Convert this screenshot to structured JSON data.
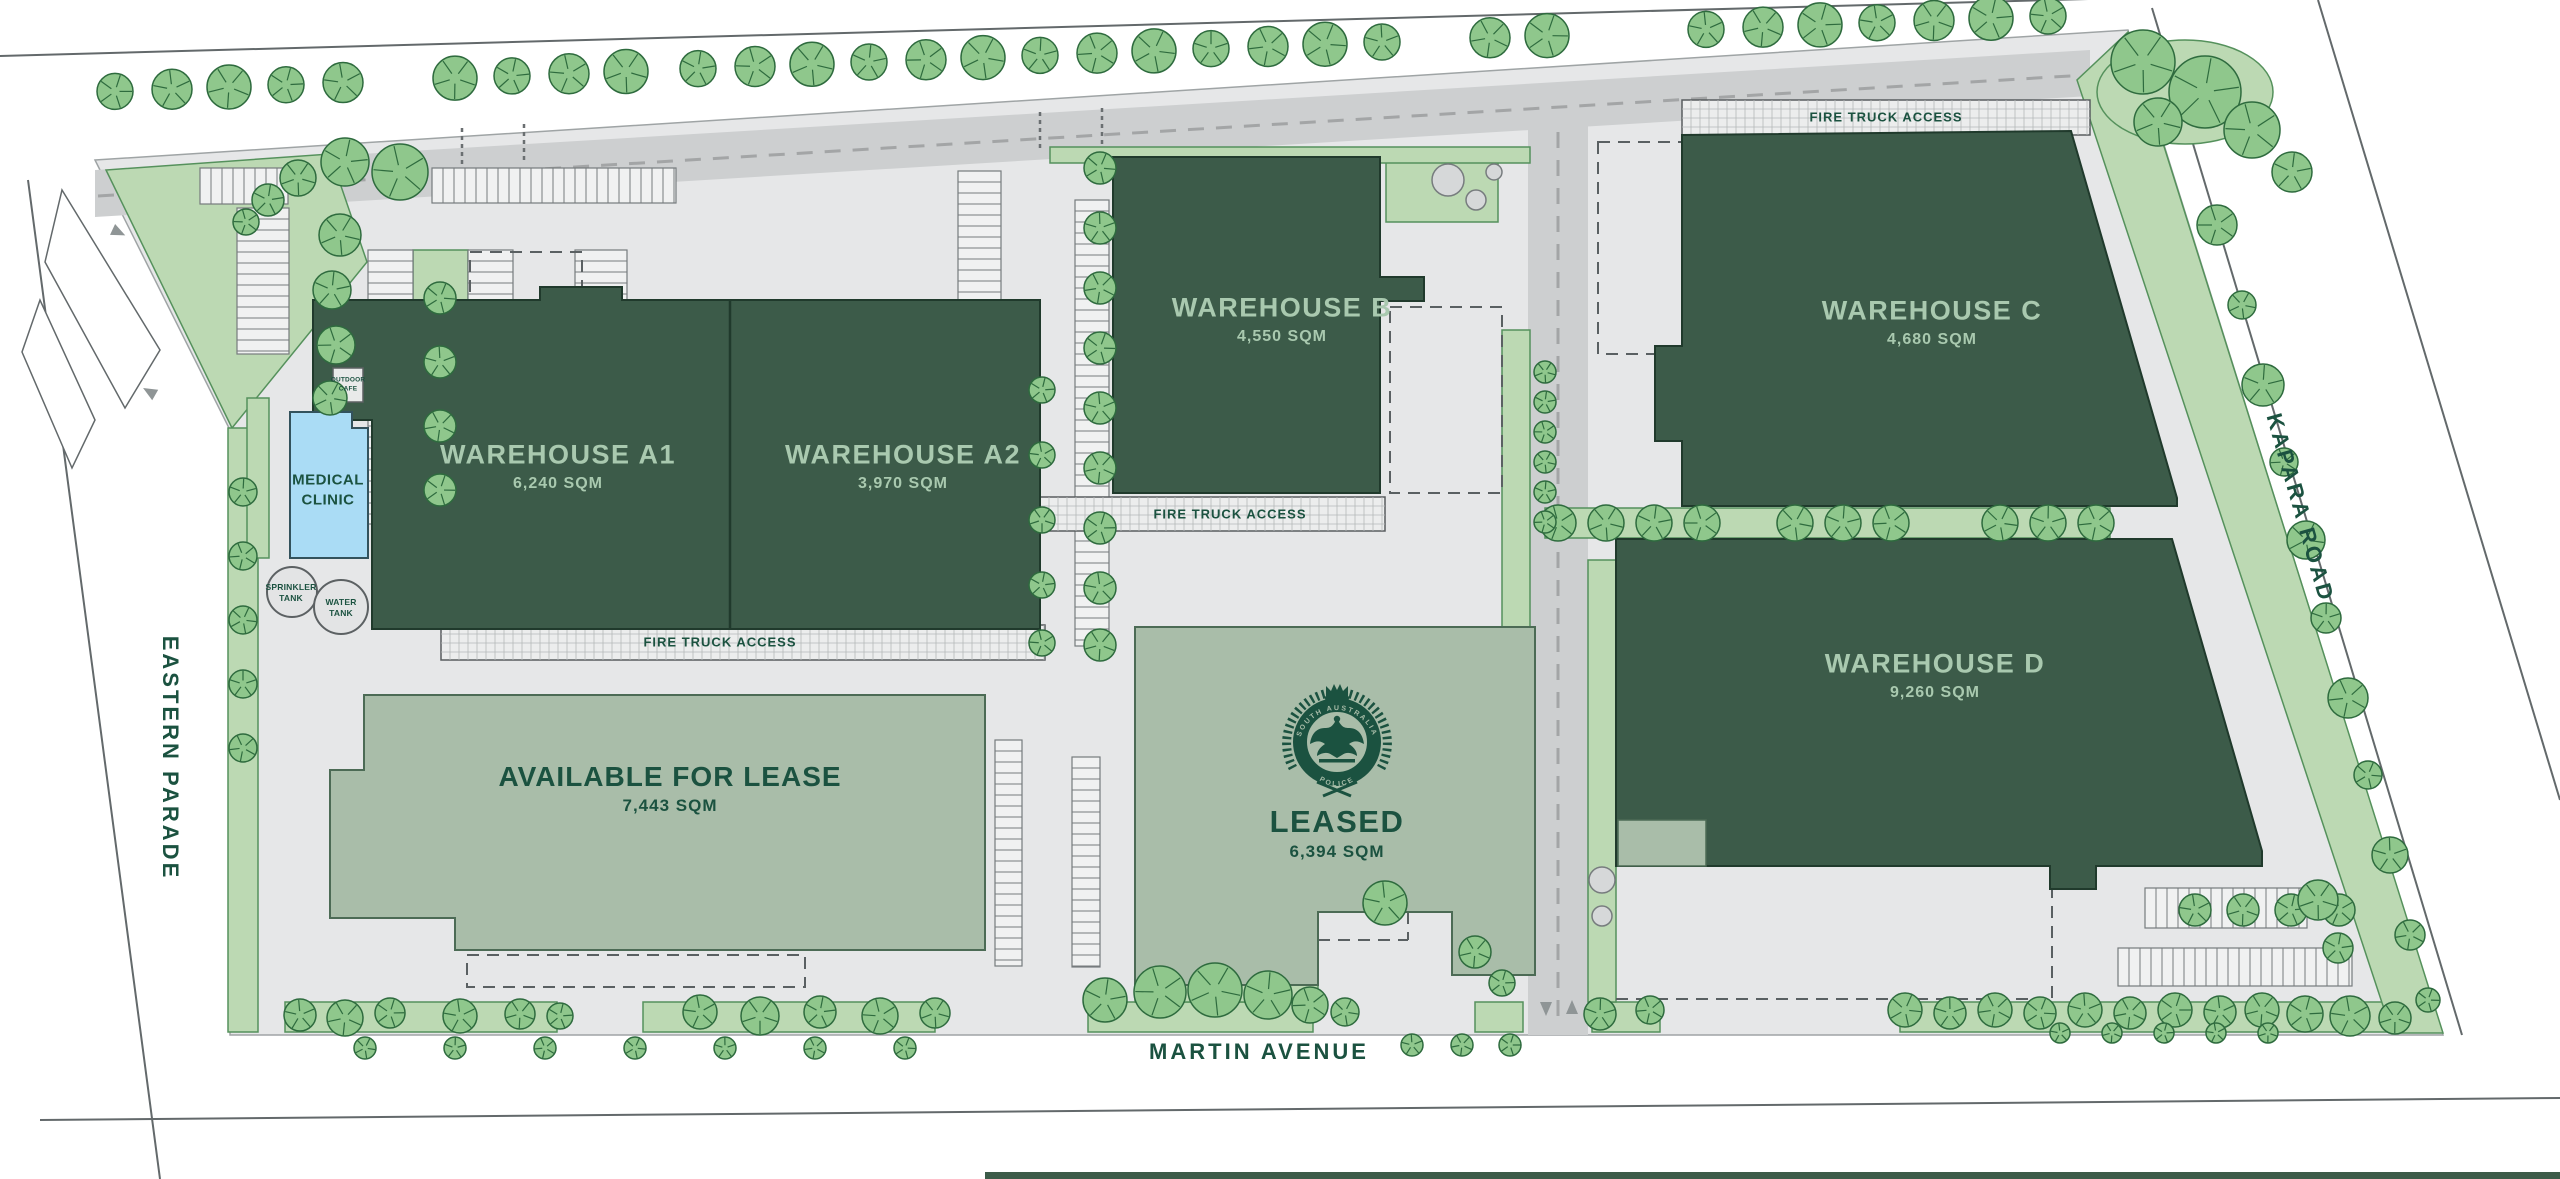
{
  "plan": {
    "buildings": {
      "a1": {
        "name": "WAREHOUSE A1",
        "area": "6,240 SQM"
      },
      "a2": {
        "name": "WAREHOUSE A2",
        "area": "3,970 SQM"
      },
      "b": {
        "name": "WAREHOUSE B",
        "area": "4,550 SQM"
      },
      "c": {
        "name": "WAREHOUSE C",
        "area": "4,680 SQM"
      },
      "d": {
        "name": "WAREHOUSE D",
        "area": "9,260 SQM"
      },
      "available": {
        "name": "AVAILABLE FOR LEASE",
        "area": "7,443 SQM"
      },
      "leased": {
        "name": "LEASED",
        "area": "6,394 SQM"
      }
    },
    "amenities": {
      "medical_clinic": {
        "line1": "MEDICAL",
        "line2": "CLINIC"
      },
      "outdoor_cafe": {
        "line1": "OUTDOOR",
        "line2": "CAFE"
      },
      "sprinkler_tank": {
        "line1": "SPRINKLER",
        "line2": "TANK"
      },
      "water_tank": {
        "line1": "WATER",
        "line2": "TANK"
      }
    },
    "roads": {
      "west": "EASTERN PARADE",
      "south": "MARTIN AVENUE",
      "east": "KAPARA ROAD"
    },
    "annotations": {
      "fire_truck_access": "FIRE TRUCK ACCESS"
    },
    "crest": {
      "icon": "south-australia-police-crest",
      "arc_top": "SOUTH AUSTRALIA",
      "arc_bottom": "POLICE"
    },
    "colors": {
      "building_dark_green": "#3c5b49",
      "building_label_green": "#a9c9af",
      "sage_building": "#a9bda9",
      "text_dark_green": "#1b5240",
      "clinic_blue": "#aadcf5",
      "verge_green": "#bcd9b3",
      "tree_green": "#8fc78c",
      "tree_outline": "#2e6b3e",
      "paving_grey": "#e6e7e8",
      "road_grey": "#cdcfd0"
    }
  }
}
